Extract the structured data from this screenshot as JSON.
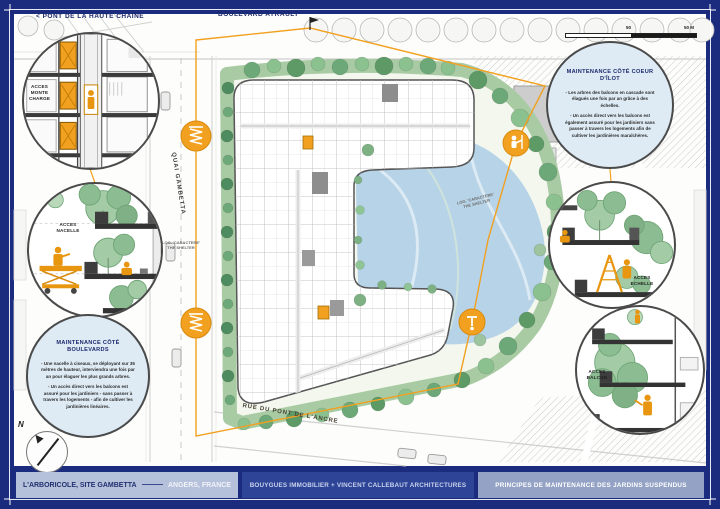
{
  "colors": {
    "frame_navy": "#1B2B7D",
    "accent_orange": "#F2A01F",
    "water_blue": "#B7D3E7",
    "foliage_green": "#6CA878"
  },
  "header": {
    "pont_label": "< PONT DE LA HAUTE CHAÎNE",
    "boulevard_label": "BOULEVARD AYRAULT"
  },
  "streets": {
    "quai": "QUAI GAMBETTA",
    "rue": "RUE DU PONT DE L'ANCRE",
    "shelter_tag": "LOG. 'CARACTERE' THE SHELTER"
  },
  "map": {
    "north_label": "N",
    "scale_mid_label": "50",
    "scale_end_label": "50 M"
  },
  "callouts": {
    "monte_charge_label": "ACCES MONTE CHARGE",
    "nacelle_label": "ACCES NACELLE",
    "echelle_label": "ACCES ECHELLE",
    "balcon_label": "ACCES BALCON",
    "boulevards": {
      "title": "MAINTENANCE CÔTÉ BOULEVARDS",
      "p1": "- Une nacelle à ciseaux, se déployant sur 35 mètres de hauteur, interviendra une fois par an pour élaguer les plus grands arbres.",
      "p2": "- Un accès direct vers les balcons est assuré pour les jardiniers - sans passer à travers les logements - afin de cultiver les jardinières linéaires."
    },
    "coeur_ilot": {
      "title": "MAINTENANCE CÔTÉ COEUR D'ÎLOT",
      "p1": "- Les arbres des balcons en cascade sont élagués une fois par an grâce à des échelles.",
      "p2": "- Un accès direct vers les balcons est également assuré pour les jardiniers sans passer à travers les logements afin de cultiver les jardinières maraîchères."
    }
  },
  "footer": {
    "project": "L'ARBORICOLE, SITE GAMBETTA",
    "location": "ANGERS, FRANCE",
    "client": "BOUYGUES IMMOBILIER + VINCENT CALLEBAUT ARCHITECTURES",
    "sheet_title": "PRINCIPES DE MAINTENANCE DES JARDINS SUSPENDUS"
  }
}
